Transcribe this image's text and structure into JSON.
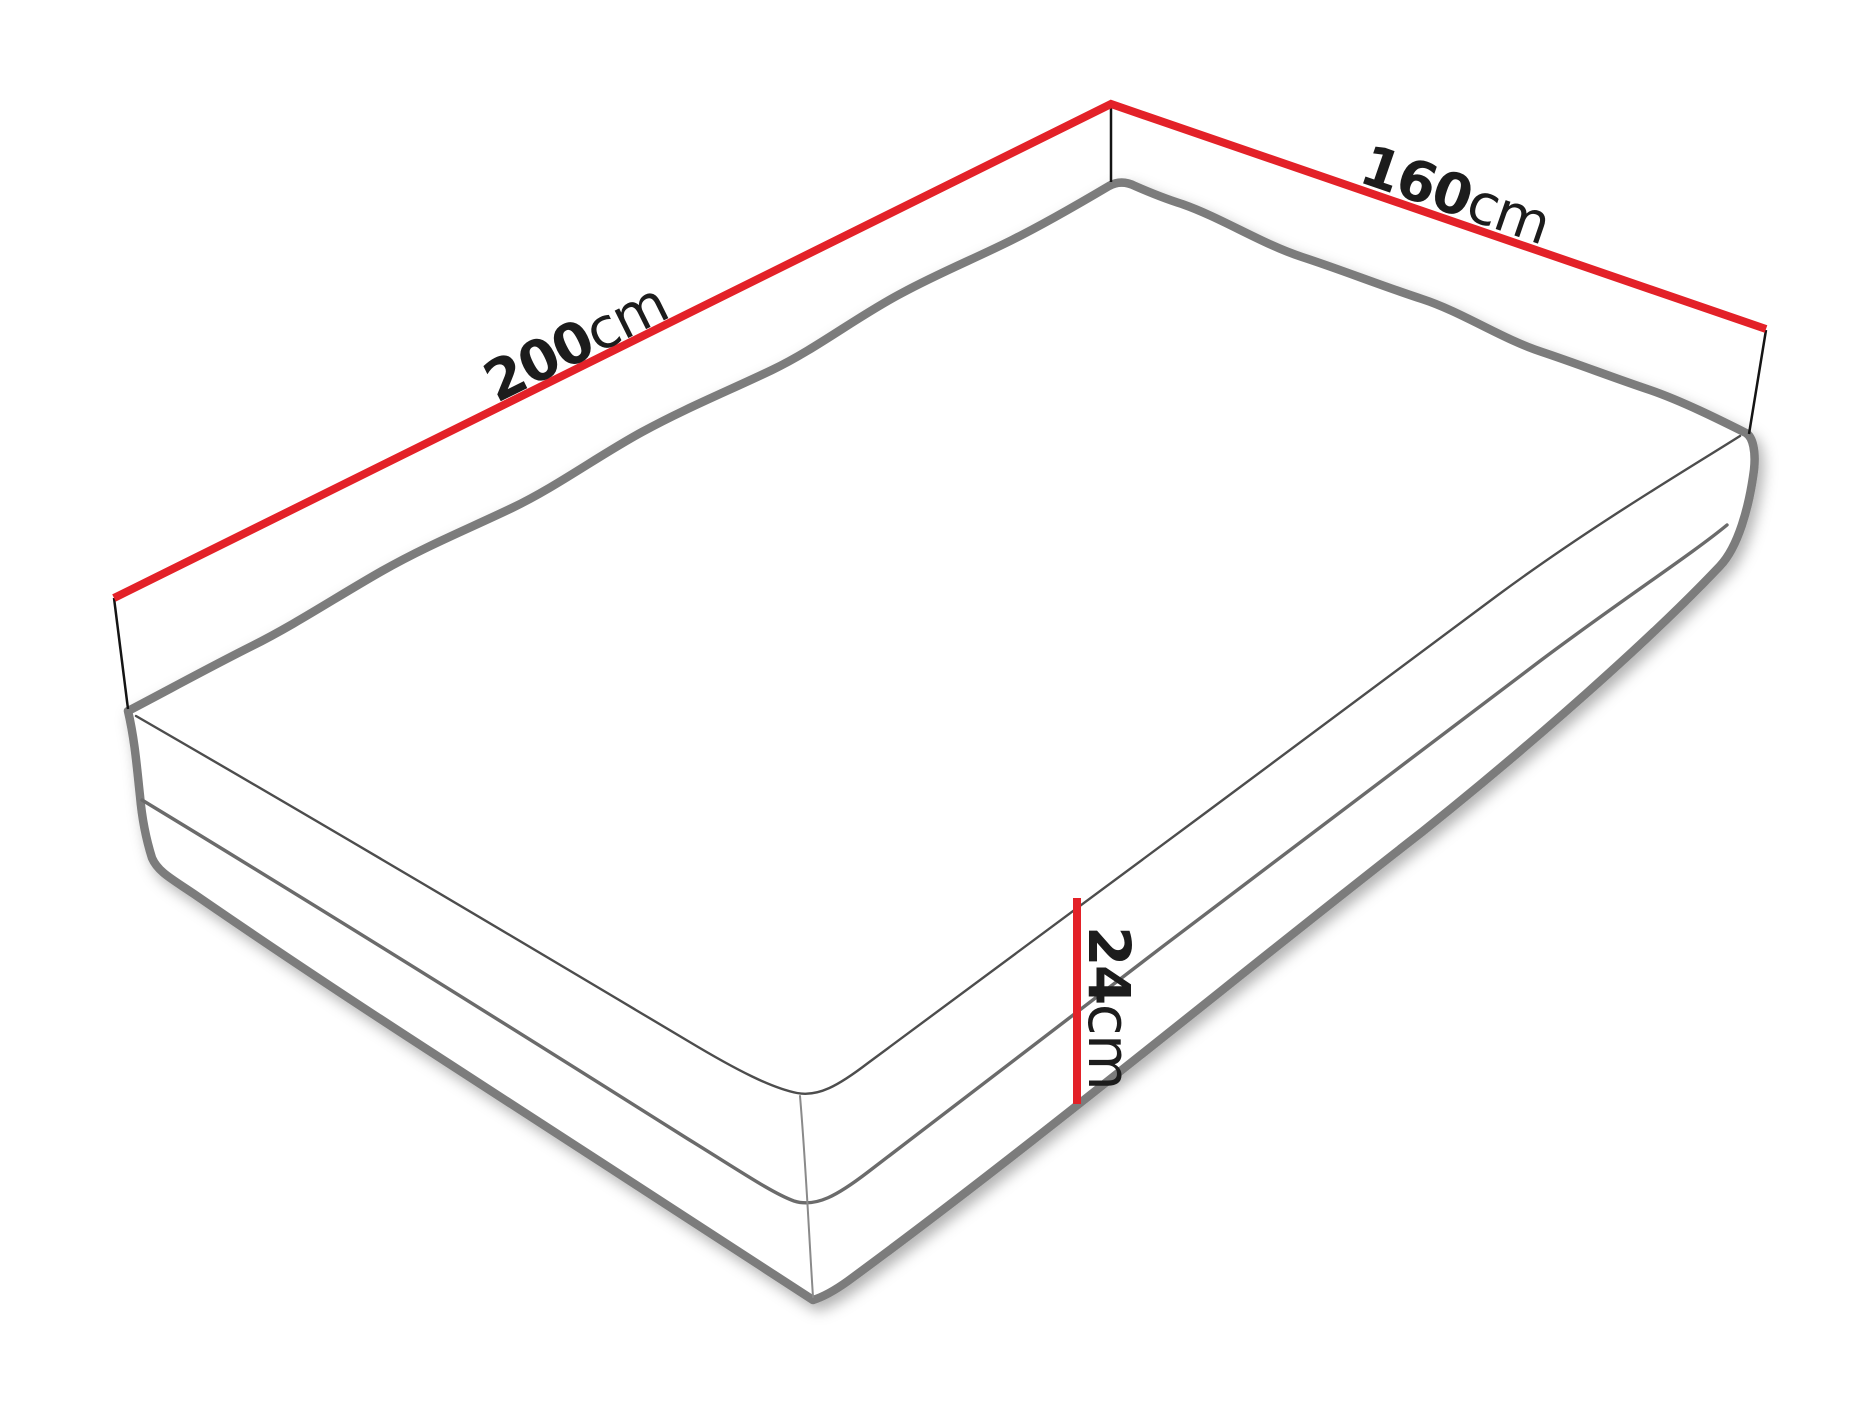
{
  "diagram": {
    "dimensions": {
      "length": {
        "value": "200",
        "unit": "cm"
      },
      "width": {
        "value": "160",
        "unit": "cm"
      },
      "height": {
        "value": "24",
        "unit": "cm"
      }
    },
    "colors": {
      "background": "#ffffff",
      "dimension_line": "#e32128",
      "tick_line": "#141414",
      "label_text": "#1c1c1c",
      "silhouette": "#7c7c7c",
      "seam": "#6b6b6b",
      "top_edge": "#4d4d4d",
      "corner_seam": "#8a8a8a"
    }
  }
}
